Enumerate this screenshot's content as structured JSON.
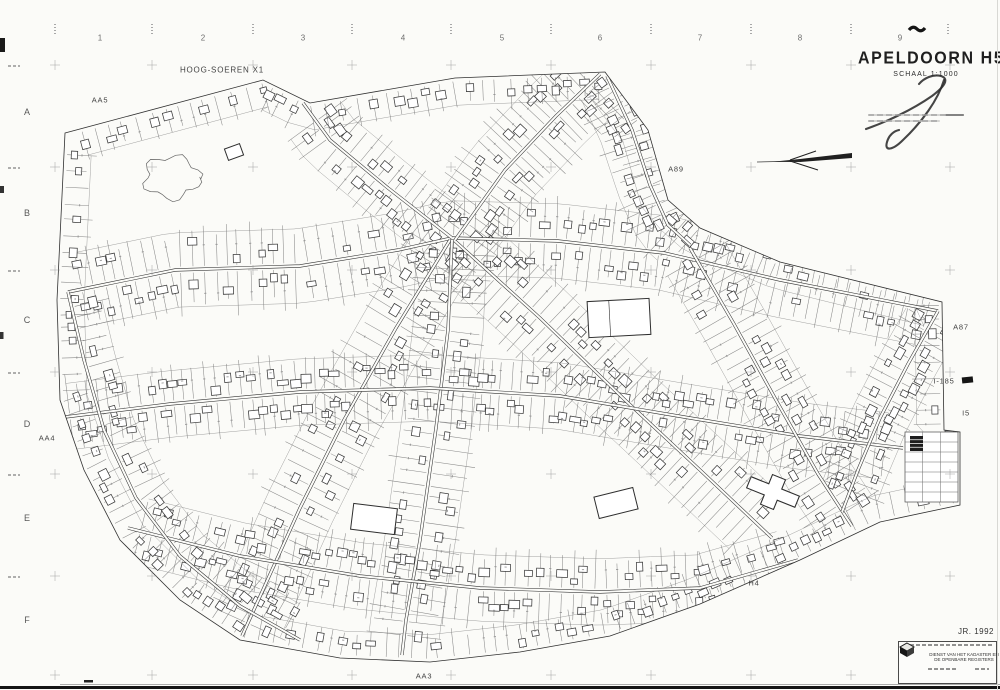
{
  "sheet": {
    "title": "APELDOORN H5",
    "scale_label": "SCHAAL 1:1000",
    "year_label": "JR. 1992",
    "paper_color": "#fbfbf8",
    "ink_color": "#2e2e2e",
    "parcel_line_color": "#6e6e6e",
    "cross_color": "#969696"
  },
  "grid": {
    "column_labels": [
      "1",
      "2",
      "3",
      "4",
      "5",
      "6",
      "7",
      "8",
      "9"
    ],
    "column_x": [
      100,
      203,
      303,
      403,
      502,
      600,
      700,
      800,
      900
    ],
    "column_label_y": 38,
    "tick_x": [
      55,
      152,
      253,
      352,
      451,
      551,
      651,
      751,
      851,
      948
    ],
    "tick_y": 24,
    "row_labels": [
      "A",
      "B",
      "C",
      "D",
      "E",
      "F"
    ],
    "row_y": [
      112,
      213,
      320,
      424,
      518,
      620
    ],
    "row_label_x": 27,
    "row_tick_y": [
      65,
      167,
      270,
      372,
      474,
      576
    ],
    "cross_x": [
      55,
      152,
      253,
      352,
      451,
      551,
      651,
      751,
      851,
      950
    ],
    "cross_y": [
      65,
      167,
      270,
      372,
      474,
      576,
      675
    ]
  },
  "map_labels": [
    {
      "name": "area-label-hoog-soeren",
      "text": "HOOG-SOEREN X1",
      "x": 222,
      "y": 70,
      "big": true
    },
    {
      "name": "section-label-aa5",
      "text": "AA5",
      "x": 100,
      "y": 100
    },
    {
      "name": "section-label-a89",
      "text": "A89",
      "x": 676,
      "y": 169
    },
    {
      "name": "section-label-a87",
      "text": "A87",
      "x": 961,
      "y": 327
    },
    {
      "name": "section-label-i185",
      "text": "I-185",
      "x": 944,
      "y": 381
    },
    {
      "name": "section-label-i5",
      "text": "I5",
      "x": 966,
      "y": 413
    },
    {
      "name": "section-label-aa4",
      "text": "AA4",
      "x": 47,
      "y": 438
    },
    {
      "name": "section-label-h4",
      "text": "H4",
      "x": 754,
      "y": 583
    },
    {
      "name": "section-label-aa3",
      "text": "AA3",
      "x": 424,
      "y": 676
    }
  ],
  "stamp": {
    "org_line1": "DIENST VAN HET KADASTER EN",
    "org_line2": "DE OPENBARE REGISTERS"
  },
  "map_geometry": {
    "seed": 11,
    "boundary": [
      [
        65,
        133
      ],
      [
        263,
        80
      ],
      [
        310,
        103
      ],
      [
        455,
        78
      ],
      [
        605,
        72
      ],
      [
        648,
        130
      ],
      [
        668,
        200
      ],
      [
        700,
        228
      ],
      [
        780,
        262
      ],
      [
        942,
        302
      ],
      [
        944,
        430
      ],
      [
        960,
        432
      ],
      [
        960,
        505
      ],
      [
        880,
        522
      ],
      [
        800,
        560
      ],
      [
        700,
        604
      ],
      [
        610,
        636
      ],
      [
        520,
        652
      ],
      [
        430,
        662
      ],
      [
        340,
        658
      ],
      [
        240,
        640
      ],
      [
        180,
        600
      ],
      [
        120,
        540
      ],
      [
        84,
        470
      ],
      [
        60,
        400
      ],
      [
        57,
        300
      ]
    ],
    "boundary_comb": {
      "spacing": 13,
      "depth": 24,
      "side": -1
    },
    "streets": [
      {
        "pts": [
          [
            68,
            292
          ],
          [
            175,
            270
          ],
          [
            300,
            266
          ],
          [
            398,
            250
          ],
          [
            452,
            238
          ],
          [
            558,
            241
          ],
          [
            664,
            253
          ],
          [
            780,
            280
          ],
          [
            938,
            311
          ]
        ],
        "spacing": 11,
        "depth": 34,
        "sides": [
          1,
          -1
        ]
      },
      {
        "pts": [
          [
            452,
            238
          ],
          [
            388,
            188
          ],
          [
            330,
            140
          ],
          [
            303,
            103
          ]
        ],
        "spacing": 10,
        "depth": 28,
        "sides": [
          1,
          -1
        ]
      },
      {
        "pts": [
          [
            455,
            240
          ],
          [
            505,
            170
          ],
          [
            556,
            116
          ],
          [
            600,
            74
          ]
        ],
        "spacing": 9,
        "depth": 36,
        "sides": [
          1,
          -1
        ]
      },
      {
        "pts": [
          [
            607,
            76
          ],
          [
            632,
            130
          ],
          [
            650,
            185
          ],
          [
            668,
            225
          ],
          [
            690,
            245
          ]
        ],
        "spacing": 9,
        "depth": 30,
        "sides": [
          1,
          -1
        ]
      },
      {
        "pts": [
          [
            450,
            240
          ],
          [
            396,
            328
          ],
          [
            344,
            420
          ],
          [
            300,
            508
          ],
          [
            262,
            592
          ],
          [
            242,
            636
          ]
        ],
        "spacing": 11,
        "depth": 32,
        "sides": [
          1,
          -1
        ]
      },
      {
        "pts": [
          [
            452,
            240
          ],
          [
            448,
            330
          ],
          [
            436,
            428
          ],
          [
            420,
            540
          ],
          [
            406,
            620
          ],
          [
            402,
            655
          ]
        ],
        "spacing": 11,
        "depth": 32,
        "sides": [
          1,
          -1
        ]
      },
      {
        "pts": [
          [
            455,
            241
          ],
          [
            540,
            318
          ],
          [
            625,
            400
          ],
          [
            700,
            470
          ],
          [
            772,
            538
          ]
        ],
        "spacing": 10,
        "depth": 34,
        "sides": [
          1,
          -1
        ]
      },
      {
        "pts": [
          [
            57,
            418
          ],
          [
            170,
            404
          ],
          [
            300,
            392
          ],
          [
            430,
            388
          ],
          [
            560,
            396
          ],
          [
            690,
            418
          ],
          [
            800,
            436
          ],
          [
            903,
            448
          ]
        ],
        "spacing": 10,
        "depth": 30,
        "sides": [
          1,
          -1
        ]
      },
      {
        "pts": [
          [
            128,
            528
          ],
          [
            240,
            556
          ],
          [
            360,
            576
          ],
          [
            480,
            588
          ],
          [
            600,
            592
          ],
          [
            700,
            588
          ],
          [
            798,
            560
          ]
        ],
        "spacing": 10,
        "depth": 30,
        "sides": [
          1,
          -1
        ]
      },
      {
        "pts": [
          [
            68,
            292
          ],
          [
            84,
            360
          ],
          [
            104,
            430
          ],
          [
            136,
            498
          ],
          [
            180,
            556
          ],
          [
            240,
            606
          ],
          [
            300,
            640
          ]
        ],
        "spacacing": 12,
        "spacing": 12,
        "depth": 28,
        "sides": [
          1
        ]
      },
      {
        "pts": [
          [
            690,
            248
          ],
          [
            734,
            324
          ],
          [
            776,
            400
          ],
          [
            818,
            474
          ],
          [
            852,
            526
          ]
        ],
        "spacing": 10,
        "depth": 30,
        "sides": [
          1,
          -1
        ]
      },
      {
        "pts": [
          [
            938,
            311
          ],
          [
            908,
            364
          ],
          [
            880,
            418
          ],
          [
            858,
            470
          ],
          [
            842,
            512
          ]
        ],
        "spacing": 10,
        "depth": 26,
        "sides": [
          1,
          -1
        ]
      }
    ],
    "woods": {
      "cx": 172,
      "cy": 177,
      "rx": 26,
      "ry": 20
    },
    "special": {
      "school_rect": {
        "x": 588,
        "y": 300,
        "w": 62,
        "h": 36,
        "angle": -3
      },
      "church": {
        "cx": 773,
        "cy": 492,
        "angle": 22
      },
      "mini_grid": {
        "x": 905,
        "y": 432,
        "w": 53,
        "h": 70,
        "cols": 3,
        "rows": 7
      },
      "dark_building": {
        "x": 910,
        "y": 436,
        "w": 13,
        "h": 15
      },
      "big_buildings": [
        {
          "x": 352,
          "y": 506,
          "w": 44,
          "h": 26,
          "angle": 7
        },
        {
          "x": 596,
          "y": 492,
          "w": 40,
          "h": 22,
          "angle": -14
        },
        {
          "x": 226,
          "y": 146,
          "w": 16,
          "h": 12,
          "angle": -20
        }
      ]
    }
  }
}
